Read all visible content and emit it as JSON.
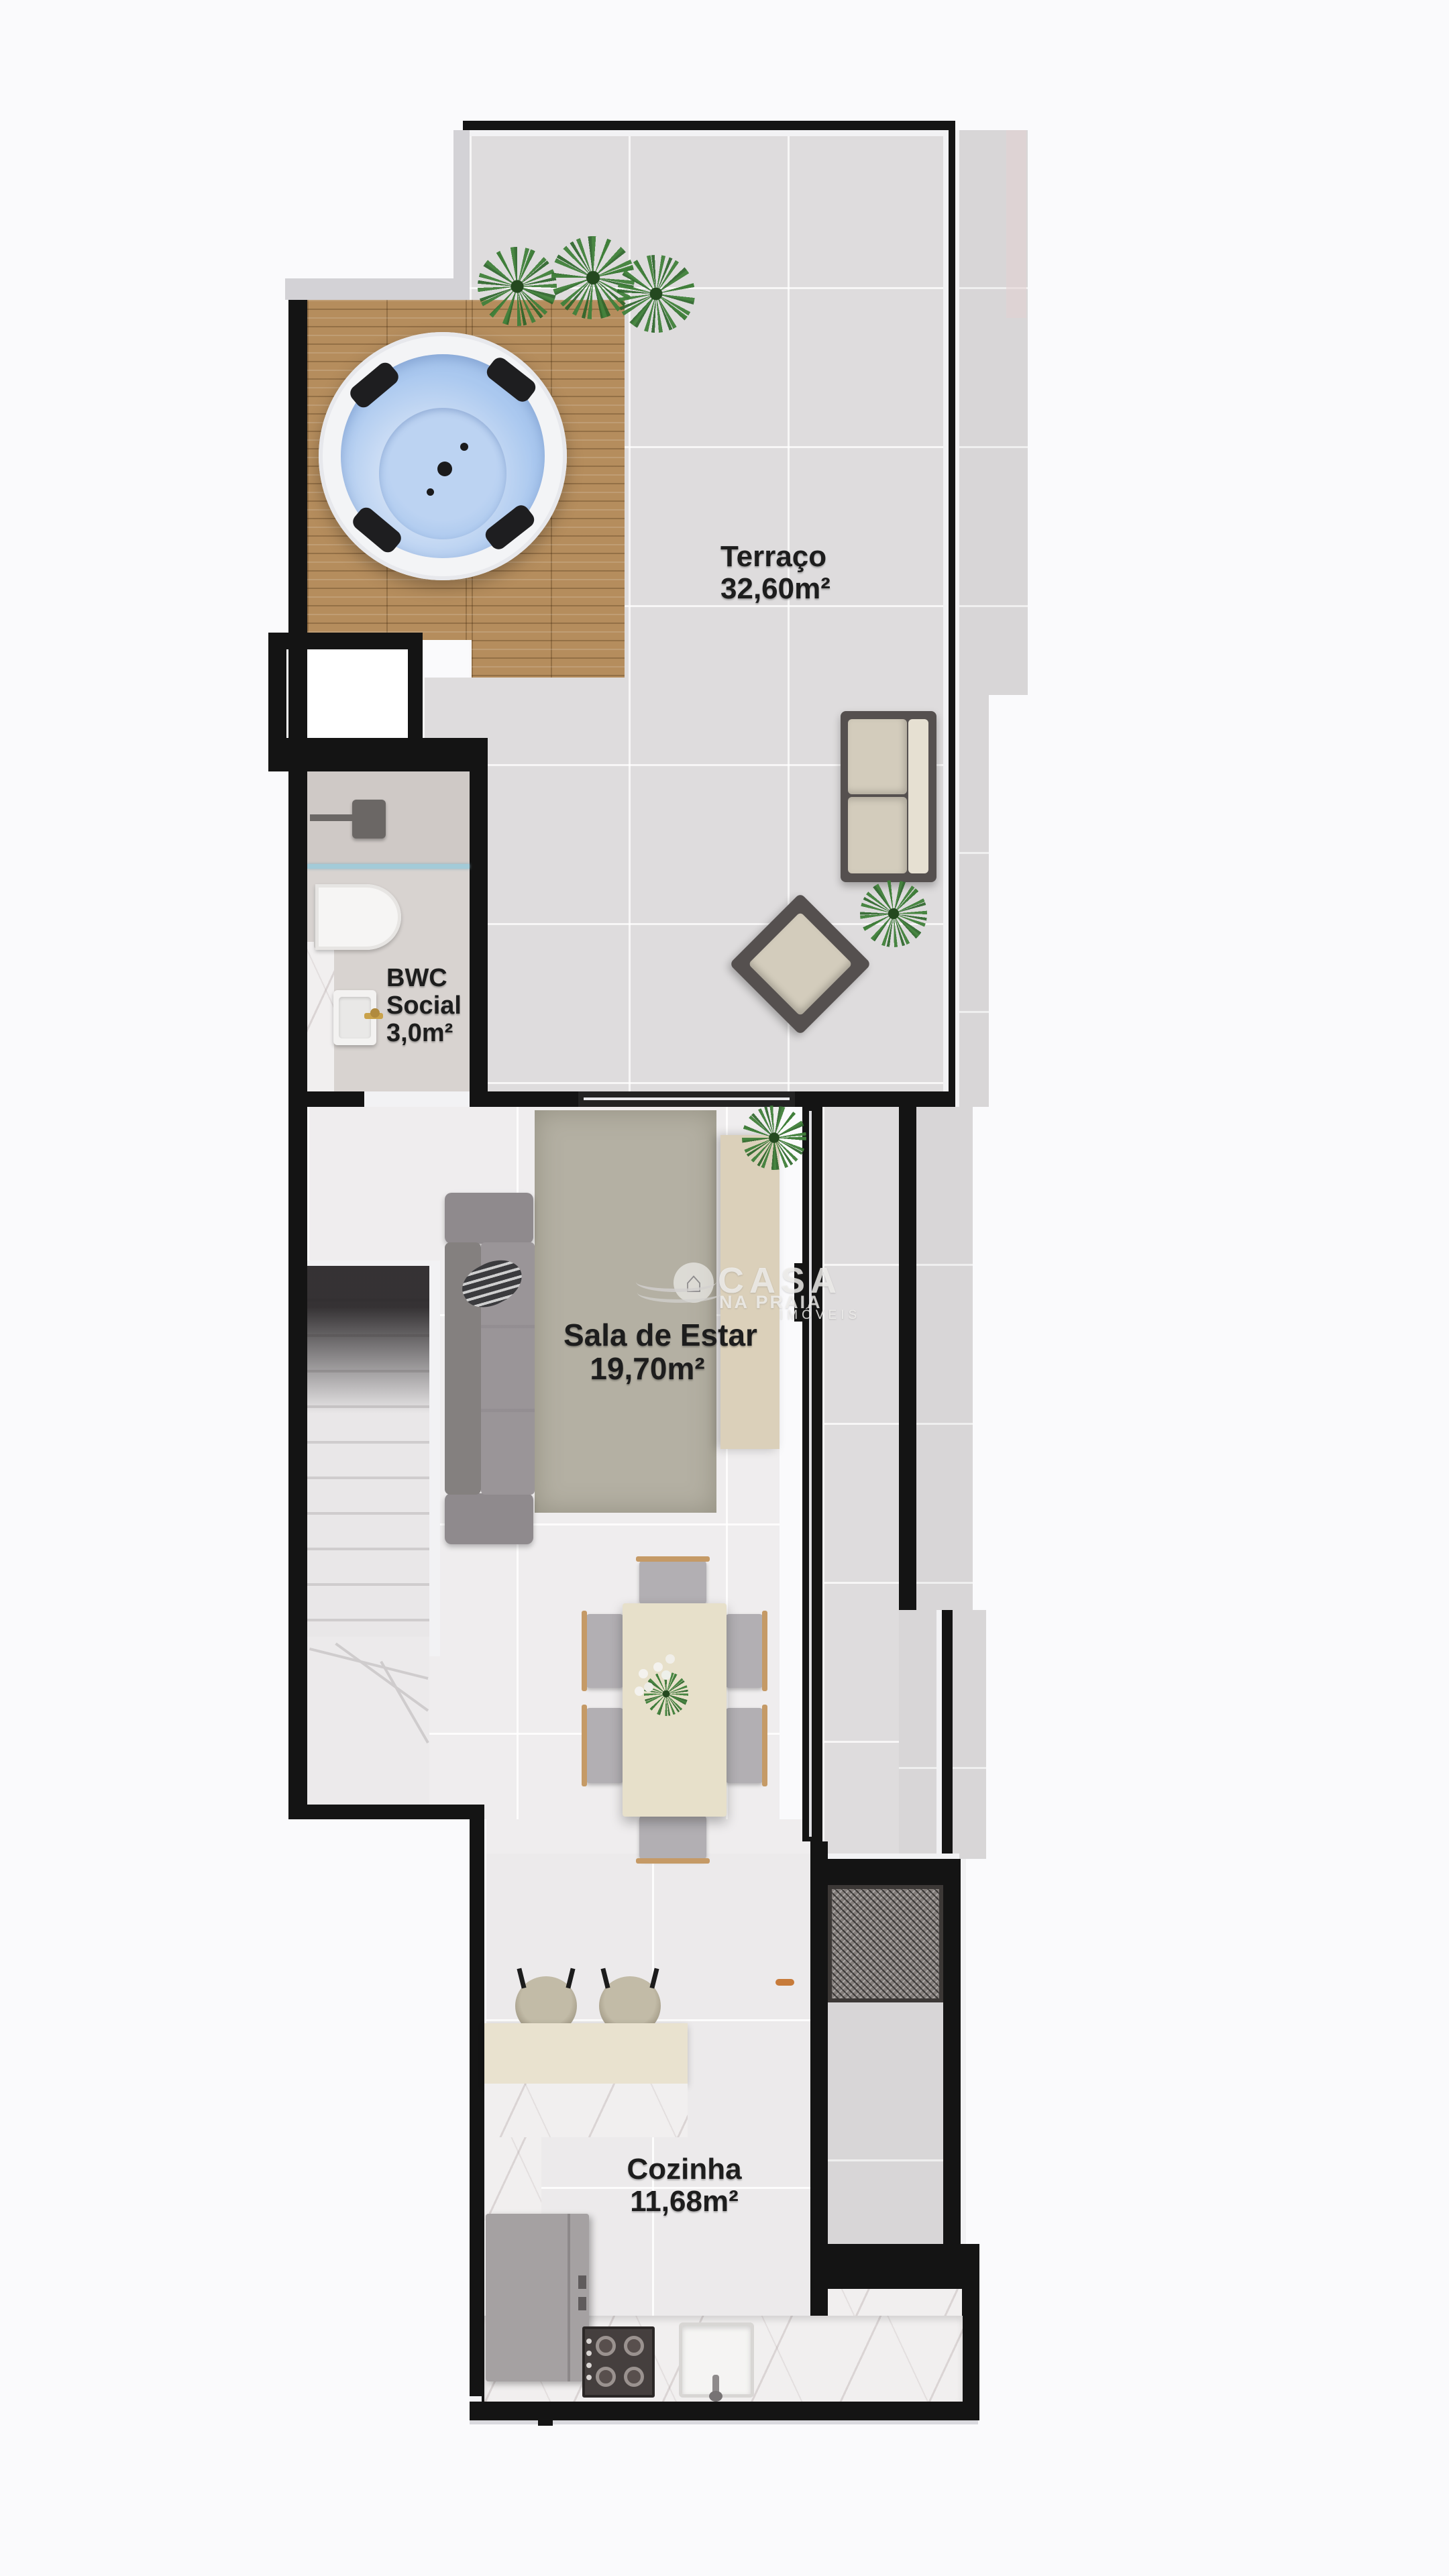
{
  "watermark": {
    "brand_line1": "CASA",
    "brand_line2": "NA PRAIA",
    "tagline": "IMÓVEIS",
    "icon": "house-in-circle-with-waves"
  },
  "rooms": {
    "terrace": {
      "name": "Terraço",
      "area": "32,60m²"
    },
    "bathroom": {
      "name_line1": "BWC",
      "name_line2": "Social",
      "area": "3,0m²"
    },
    "living": {
      "name": "Sala de Estar",
      "area": "19,70m²"
    },
    "kitchen": {
      "name": "Cozinha",
      "area": "11,68m²"
    }
  },
  "colors": {
    "background": "#fafafc",
    "wall": "#141414",
    "terrace_tile": "#dedcdd",
    "living_tile": "#efedee",
    "deck_wood": "#b58d5d",
    "hot_tub_water": "#a9c7ee",
    "rug": "#b4b0a3",
    "table": "#e7e0ca",
    "label_text": "#1d1d1d",
    "accent_handle": "#c77b3a"
  },
  "furniture": [
    "hot-tub",
    "wood-deck",
    "planter-plants",
    "outdoor-sofa",
    "outdoor-armchair",
    "terrace-plant",
    "staircase",
    "indoor-sofa",
    "throw-pillow",
    "area-rug",
    "tv-console",
    "console-plant",
    "dining-table",
    "dining-chairs",
    "flower-centerpiece",
    "bar-stools",
    "breakfast-counter",
    "kitchen-counter",
    "refrigerator",
    "cooktop",
    "kitchen-sink",
    "toilet",
    "bathroom-vanity",
    "shower-head",
    "glass-partition",
    "barbecue-grill",
    "door-handle"
  ]
}
